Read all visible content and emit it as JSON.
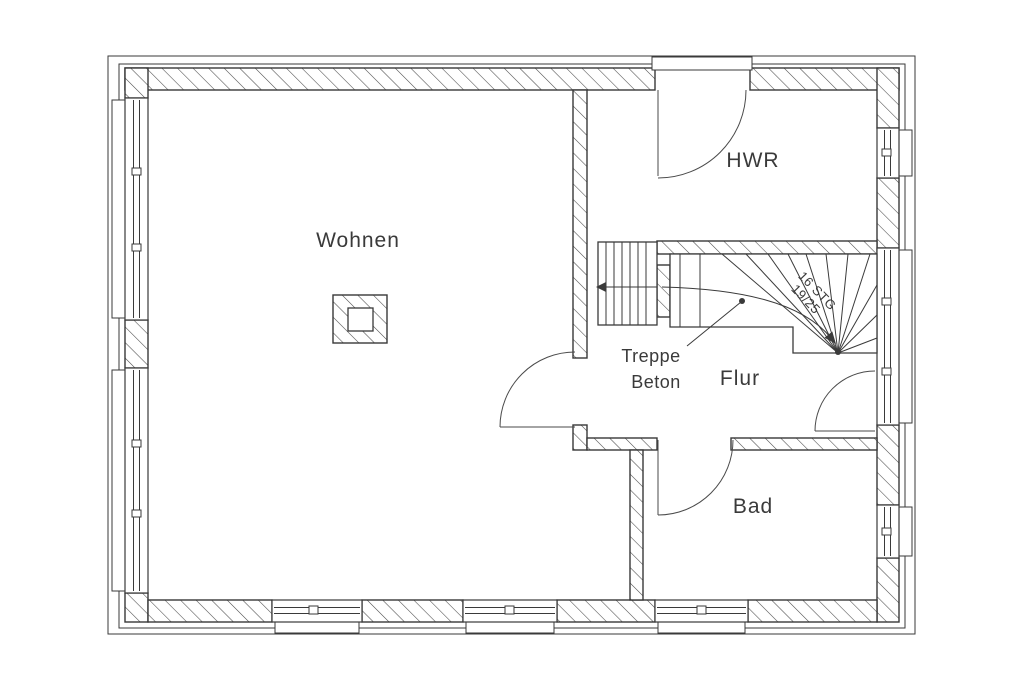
{
  "rooms": {
    "wohnen": "Wohnen",
    "hwr": "HWR",
    "flur": "Flur",
    "bad": "Bad"
  },
  "stairs": {
    "material_line1": "Treppe",
    "material_line2": "Beton",
    "note_line1": "16 STG",
    "note_line2": "19/25"
  },
  "colors": {
    "background": "#ffffff",
    "line": "#3a3a3a"
  }
}
